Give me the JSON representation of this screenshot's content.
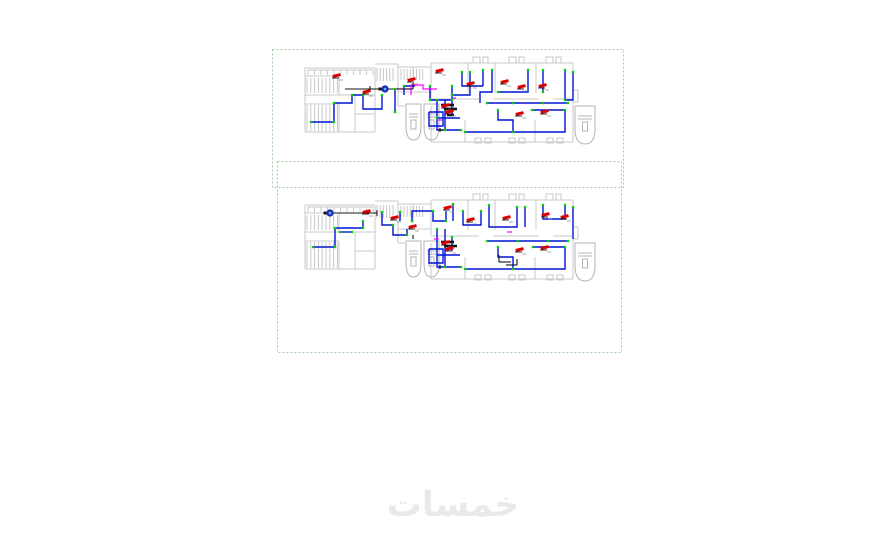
{
  "page": {
    "background": "#ffffff",
    "watermark": {
      "text": "خمسات",
      "color": "#e9e9e9"
    }
  },
  "colors": {
    "wall": "#c9c9c9",
    "wall_dark": "#b4b4b4",
    "pipe": "#0013d6",
    "junction": "#00d400",
    "device": "#dd0000",
    "magenta": "#ff00ff",
    "black": "#141414",
    "label": "#8a8a8a",
    "frame": "#a8cfa8",
    "pump": "#2244cc",
    "pump_core": "#8ab4ff"
  },
  "frames": [
    {
      "name": "viewport-frame-upper",
      "x": 272,
      "y": 49,
      "w": 351,
      "h": 138
    },
    {
      "name": "viewport-frame-lower",
      "x": 277,
      "y": 161,
      "w": 344,
      "h": 191
    }
  ],
  "architecture": {
    "lines": [
      [
        2,
        6,
        72,
        6
      ],
      [
        2,
        6,
        2,
        70
      ],
      [
        2,
        70,
        72,
        70
      ],
      [
        72,
        6,
        72,
        70
      ],
      [
        2,
        33,
        72,
        33
      ],
      [
        36,
        14,
        36,
        33
      ],
      [
        36,
        42,
        36,
        70
      ],
      [
        2,
        14,
        36,
        14
      ],
      [
        2,
        42,
        36,
        42
      ],
      [
        52,
        33,
        52,
        70
      ],
      [
        52,
        52,
        72,
        52
      ],
      [
        5,
        8,
        70,
        8
      ],
      [
        72,
        2,
        95,
        2
      ],
      [
        95,
        2,
        95,
        30
      ],
      [
        95,
        5,
        128,
        5
      ],
      [
        110,
        5,
        110,
        24
      ],
      [
        95,
        30,
        128,
        30
      ],
      [
        128,
        1,
        270,
        1
      ],
      [
        270,
        1,
        270,
        80
      ],
      [
        128,
        80,
        270,
        80
      ],
      [
        128,
        1,
        128,
        36
      ],
      [
        128,
        44,
        128,
        80
      ],
      [
        128,
        37,
        176,
        37
      ],
      [
        190,
        37,
        236,
        37
      ],
      [
        250,
        37,
        270,
        37
      ],
      [
        165,
        1,
        165,
        31
      ],
      [
        192,
        1,
        192,
        31
      ],
      [
        233,
        1,
        233,
        31
      ],
      [
        162,
        58,
        162,
        80
      ],
      [
        232,
        58,
        232,
        80
      ],
      [
        270,
        28,
        275,
        28
      ],
      [
        275,
        28,
        275,
        40
      ],
      [
        270,
        40,
        275,
        40
      ],
      [
        95,
        30,
        95,
        44
      ],
      [
        95,
        44,
        102,
        44
      ]
    ],
    "stair_hatches": [
      {
        "x": 4,
        "y": 16,
        "w": 31,
        "h": 15,
        "step": 3.8
      },
      {
        "x": 4,
        "y": 43,
        "w": 31,
        "h": 26,
        "step": 3.8
      },
      {
        "x": 5,
        "y": 8,
        "w": 65,
        "h": 5,
        "step": 6.5
      },
      {
        "x": 74,
        "y": 6,
        "w": 19,
        "h": 13,
        "step": 3.2
      },
      {
        "x": 98,
        "y": 7,
        "w": 22,
        "h": 11,
        "step": 3.1
      }
    ],
    "top_tabs": [
      170,
      206,
      243
    ],
    "door_pairs": [
      172,
      206,
      244
    ],
    "elevators": [
      {
        "x": 103,
        "y": 42,
        "w": 15,
        "h": 36
      },
      {
        "x": 121,
        "y": 42,
        "w": 15,
        "h": 36
      },
      {
        "x": 272,
        "y": 44,
        "w": 20,
        "h": 38
      }
    ]
  },
  "plans": [
    {
      "name": "floor-plan-upper",
      "origin": [
        303,
        62
      ],
      "pipes": [
        [
          8,
          60,
          31,
          60,
          31,
          41,
          49,
          41,
          49,
          33,
          60,
          33
        ],
        [
          60,
          33,
          60,
          47,
          79,
          47,
          79,
          33
        ],
        [
          92,
          27,
          92,
          50
        ],
        [
          101,
          33,
          101,
          24,
          112,
          24
        ],
        [
          127,
          24,
          127,
          38,
          149,
          38,
          149,
          24
        ],
        [
          149,
          33,
          167,
          33,
          167,
          10
        ],
        [
          159,
          10,
          159,
          24,
          180,
          24
        ],
        [
          180,
          8,
          180,
          24
        ],
        [
          189,
          8,
          189,
          30,
          177,
          30,
          177,
          41
        ],
        [
          195,
          30,
          225,
          30,
          225,
          8
        ],
        [
          240,
          8,
          240,
          30
        ],
        [
          262,
          8,
          262,
          38
        ],
        [
          270,
          10,
          270,
          38,
          262,
          38
        ],
        [
          184,
          41,
          265,
          41
        ],
        [
          162,
          70,
          262,
          70,
          262,
          48,
          229,
          48
        ],
        [
          195,
          48,
          195,
          58,
          210,
          58,
          210,
          70
        ],
        [
          134,
          38,
          134,
          68,
          158,
          68
        ],
        [
          126,
          50,
          140,
          50,
          140,
          64,
          126,
          64,
          126,
          50
        ],
        [
          134,
          56,
          157,
          56
        ],
        [
          142,
          38,
          142,
          68
        ],
        [
          149,
          38,
          149,
          52
        ]
      ],
      "magenta": [
        [
          92,
          27,
          108,
          27,
          108,
          23,
          120,
          23,
          120,
          27,
          134,
          27
        ],
        [
          108,
          27,
          108,
          33
        ],
        [
          135,
          58,
          139,
          58
        ],
        [
          150,
          36,
          153,
          36
        ]
      ],
      "black_lines": [
        [
          42,
          27,
          110,
          27
        ],
        [
          67,
          24,
          67,
          30
        ],
        [
          110,
          21,
          110,
          27
        ],
        [
          137,
          66,
          137,
          70
        ],
        [
          135,
          68,
          141,
          68
        ]
      ],
      "black_bars": [
        [
          138,
          43,
          151,
          43
        ],
        [
          141,
          47,
          154,
          47
        ],
        [
          144,
          53,
          151,
          53
        ]
      ],
      "pumps": [
        [
          82,
          27
        ]
      ],
      "devices": [
        [
          34,
          15
        ],
        [
          109,
          19
        ],
        [
          64,
          31
        ],
        [
          137,
          10
        ],
        [
          168,
          23
        ],
        [
          202,
          21
        ],
        [
          219,
          26
        ],
        [
          240,
          25
        ],
        [
          143,
          45
        ],
        [
          147,
          51
        ],
        [
          217,
          53
        ],
        [
          242,
          51
        ]
      ],
      "junctions": [
        [
          8,
          60
        ],
        [
          31,
          60
        ],
        [
          31,
          41
        ],
        [
          49,
          33
        ],
        [
          60,
          33
        ],
        [
          79,
          33
        ],
        [
          92,
          27
        ],
        [
          92,
          50
        ],
        [
          101,
          24
        ],
        [
          127,
          24
        ],
        [
          149,
          24
        ],
        [
          149,
          33
        ],
        [
          167,
          10
        ],
        [
          159,
          10
        ],
        [
          180,
          8
        ],
        [
          189,
          8
        ],
        [
          195,
          30
        ],
        [
          225,
          8
        ],
        [
          240,
          8
        ],
        [
          262,
          8
        ],
        [
          270,
          10
        ],
        [
          184,
          41
        ],
        [
          210,
          41
        ],
        [
          240,
          41
        ],
        [
          265,
          41
        ],
        [
          162,
          70
        ],
        [
          262,
          48
        ],
        [
          229,
          48
        ],
        [
          195,
          48
        ],
        [
          210,
          70
        ],
        [
          134,
          38
        ],
        [
          158,
          68
        ],
        [
          134,
          56
        ],
        [
          149,
          38
        ],
        [
          240,
          30
        ],
        [
          262,
          38
        ],
        [
          127,
          38
        ],
        [
          142,
          68
        ]
      ]
    },
    {
      "name": "floor-plan-lower",
      "origin": [
        303,
        199
      ],
      "pipes": [
        [
          10,
          48,
          32,
          48,
          32,
          29,
          60,
          29,
          60,
          22
        ],
        [
          37,
          33,
          49,
          33
        ],
        [
          79,
          13,
          79,
          26,
          90,
          26,
          90,
          36,
          104,
          36,
          104,
          30
        ],
        [
          97,
          13,
          97,
          22
        ],
        [
          109,
          22,
          109,
          12,
          130,
          12,
          130,
          22,
          143,
          22,
          143,
          12
        ],
        [
          150,
          5,
          150,
          22
        ],
        [
          160,
          12,
          160,
          26,
          178,
          26,
          178,
          12
        ],
        [
          186,
          6,
          186,
          28,
          214,
          28,
          214,
          8
        ],
        [
          222,
          8,
          222,
          28
        ],
        [
          240,
          6,
          240,
          20,
          262,
          20,
          262,
          6
        ],
        [
          270,
          8,
          270,
          40
        ],
        [
          184,
          42,
          265,
          42
        ],
        [
          162,
          70,
          262,
          70,
          262,
          48,
          230,
          48
        ],
        [
          195,
          48,
          195,
          58,
          210,
          58,
          210,
          70
        ],
        [
          134,
          30,
          134,
          68,
          158,
          68
        ],
        [
          126,
          50,
          140,
          50,
          140,
          64,
          126,
          64,
          126,
          50
        ],
        [
          134,
          56,
          157,
          56
        ],
        [
          142,
          30,
          142,
          68
        ],
        [
          149,
          38,
          149,
          52
        ]
      ],
      "magenta": [
        [
          204,
          33,
          209,
          33
        ],
        [
          131,
          40,
          136,
          40
        ]
      ],
      "black_lines": [
        [
          27,
          14,
          74,
          14
        ],
        [
          74,
          11,
          74,
          17
        ],
        [
          196,
          56,
          196,
          63
        ],
        [
          196,
          63,
          208,
          63
        ],
        [
          203,
          66,
          214,
          66
        ],
        [
          214,
          60,
          214,
          66
        ],
        [
          110,
          36,
          110,
          40
        ],
        [
          137,
          66,
          137,
          70
        ]
      ],
      "black_bars": [
        [
          138,
          43,
          151,
          43
        ],
        [
          141,
          47,
          154,
          47
        ]
      ],
      "pumps": [
        [
          27,
          14
        ]
      ],
      "devices": [
        [
          64,
          14
        ],
        [
          92,
          20
        ],
        [
          145,
          10
        ],
        [
          168,
          22
        ],
        [
          204,
          20
        ],
        [
          243,
          17
        ],
        [
          262,
          19
        ],
        [
          143,
          45
        ],
        [
          147,
          51
        ],
        [
          217,
          52
        ],
        [
          242,
          50
        ],
        [
          110,
          29
        ]
      ],
      "junctions": [
        [
          10,
          48
        ],
        [
          32,
          48
        ],
        [
          32,
          29
        ],
        [
          60,
          29
        ],
        [
          60,
          22
        ],
        [
          37,
          33
        ],
        [
          49,
          33
        ],
        [
          79,
          13
        ],
        [
          90,
          26
        ],
        [
          104,
          36
        ],
        [
          97,
          13
        ],
        [
          109,
          22
        ],
        [
          130,
          12
        ],
        [
          143,
          22
        ],
        [
          150,
          5
        ],
        [
          160,
          12
        ],
        [
          178,
          12
        ],
        [
          186,
          6
        ],
        [
          214,
          8
        ],
        [
          222,
          8
        ],
        [
          240,
          6
        ],
        [
          262,
          6
        ],
        [
          270,
          8
        ],
        [
          184,
          42
        ],
        [
          215,
          42
        ],
        [
          245,
          42
        ],
        [
          265,
          42
        ],
        [
          162,
          70
        ],
        [
          262,
          48
        ],
        [
          230,
          48
        ],
        [
          195,
          48
        ],
        [
          210,
          70
        ],
        [
          134,
          30
        ],
        [
          158,
          68
        ],
        [
          142,
          68
        ],
        [
          149,
          38
        ]
      ]
    }
  ]
}
